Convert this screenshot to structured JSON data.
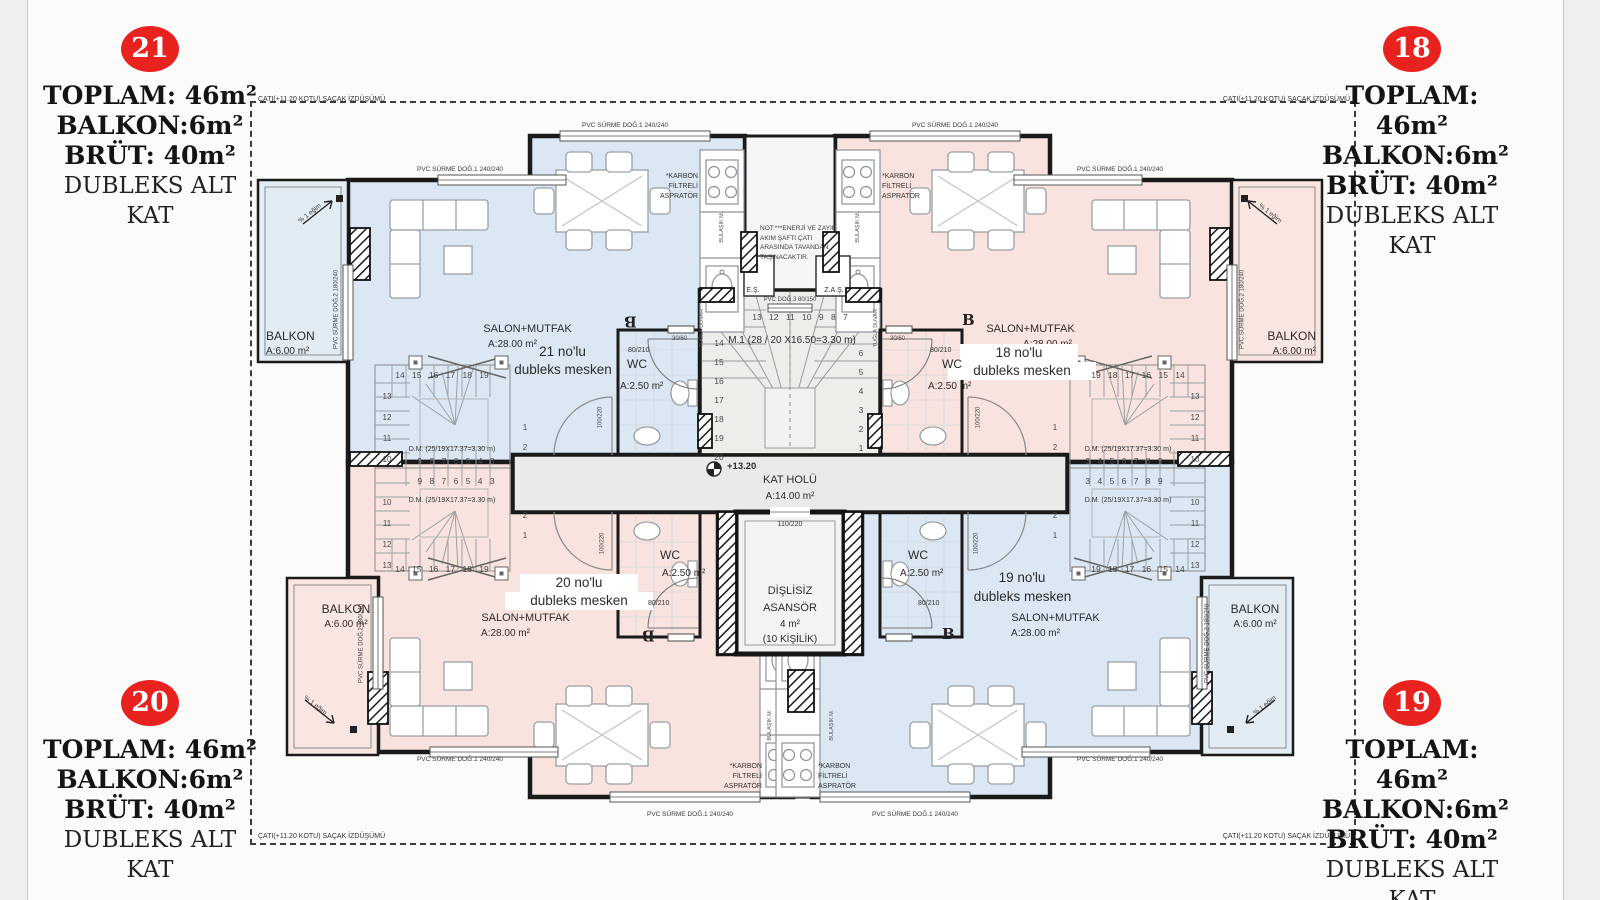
{
  "badge_color": "#e8221f",
  "colors": {
    "unit_blue": "#dbe7f2",
    "unit_pink": "#f8e3de",
    "core_gray": "#ededea"
  },
  "corners": {
    "tl": {
      "no": "21",
      "toplam": "TOPLAM: 46m²",
      "balkon": "BALKON:6m²",
      "brut": "BRÜT: 40m²",
      "kat": "DUBLEKS ALT KAT"
    },
    "tr": {
      "no": "18",
      "toplam": "TOPLAM: 46m²",
      "balkon": "BALKON:6m²",
      "brut": "BRÜT: 40m²",
      "kat": "DUBLEKS ALT KAT"
    },
    "bl": {
      "no": "20",
      "toplam": "TOPLAM: 46m²",
      "balkon": "BALKON:6m²",
      "brut": "BRÜT: 40m²",
      "kat": "DUBLEKS ALT KAT"
    },
    "br": {
      "no": "19",
      "toplam": "TOPLAM: 46m²",
      "balkon": "BALKON:6m²",
      "brut": "BRÜT: 40m²",
      "kat": "DUBLEKS ALT KAT"
    }
  },
  "roof": {
    "label": "ÇATI(+11.20 KOTU) SAÇAK İZDÜŞÜMÜ"
  },
  "units": {
    "u21": {
      "no": "21 no'lu",
      "type": "dubleks mesken",
      "room": "SALON+MUTFAK",
      "area": "A:28.00 m²"
    },
    "u18": {
      "no": "18 no'lu",
      "type": "dubleks mesken",
      "room": "SALON+MUTFAK",
      "area": "A:28.00 m²"
    },
    "u20": {
      "no": "20 no'lu",
      "type": "dubleks mesken",
      "room": "SALON+MUTFAK",
      "area": "A:28.00 m²"
    },
    "u19": {
      "no": "19 no'lu",
      "type": "dubleks mesken",
      "room": "SALON+MUTFAK",
      "area": "A:28.00 m²"
    }
  },
  "balcony": {
    "label": "BALKON",
    "area": "A:6.00 m²",
    "window": "PVC SÜRME DOĞ.2  180/240",
    "slope": "% 1 eğim"
  },
  "wc": {
    "label": "WC",
    "area": "A:2.50 m²",
    "door": "80/210",
    "entry": "100/220",
    "window": "30/60"
  },
  "core": {
    "stair": "M.1 (28 / 20 X16.50=3.30 m)",
    "hall": "KAT HOLÜ",
    "hall_area": "A:14.00 m²",
    "level": "+13.20",
    "lift1": "DİŞLİSİZ",
    "lift2": "ASANSÖR",
    "lift_area": "4 m²",
    "lift_cap": "(10 KİŞİLİK)",
    "lift_door": "110/220",
    "es": "E.Ş.",
    "zas": "Z.A.Ş.",
    "pvc3": "PVC DOĞ.3 80/150",
    "wall": "TUĞLA DUVAR",
    "note": "NOT:***ENERJİ VE ZAYIF\nAKIM ŞAFTI ÇATI\nARASINDA TAVANDAN\nTAŞINACAKTIR.",
    "num_top": "13 12 11 10 9 8 7",
    "num_left": "14\n15\n16\n17\n18\n19\n20",
    "num_right": "6\n5\n4\n3\n2\n1"
  },
  "dm": {
    "label": "D.M. (25/19X17.37=3.30 m)",
    "top": {
      "r1": "14 15 16 17 18 19",
      "col": "13\n12\n11\n10",
      "r3": "9 8 7 6 5 4 3",
      "side": "1\n2"
    },
    "top_m": {
      "r1": "19 18 17 16 15 14",
      "col": "13\n12\n11\n10",
      "r3": "3 4 5 6 7 8 9",
      "side": "1\n2"
    },
    "bot": {
      "r1": "9 8 7 6 5 4 3",
      "col": "10\n11\n12\n13",
      "r3": "14 15 16 17 18 19",
      "side": "2\n1"
    },
    "bot_m": {
      "r1": "3 4 5 6 7 8 9",
      "col": "10\n11\n12\n13",
      "r3": "19 18 17 16 15 14",
      "side": "2\n1"
    }
  },
  "kitchen": {
    "aspirator": "*KARBON\nFİLTRELİ\nASPRATÖR",
    "sink": "BULAŞIK M."
  },
  "window": {
    "pvc1": "PVC SÜRME DOĞ.1  240/240"
  },
  "section": {
    "mark": "B"
  }
}
